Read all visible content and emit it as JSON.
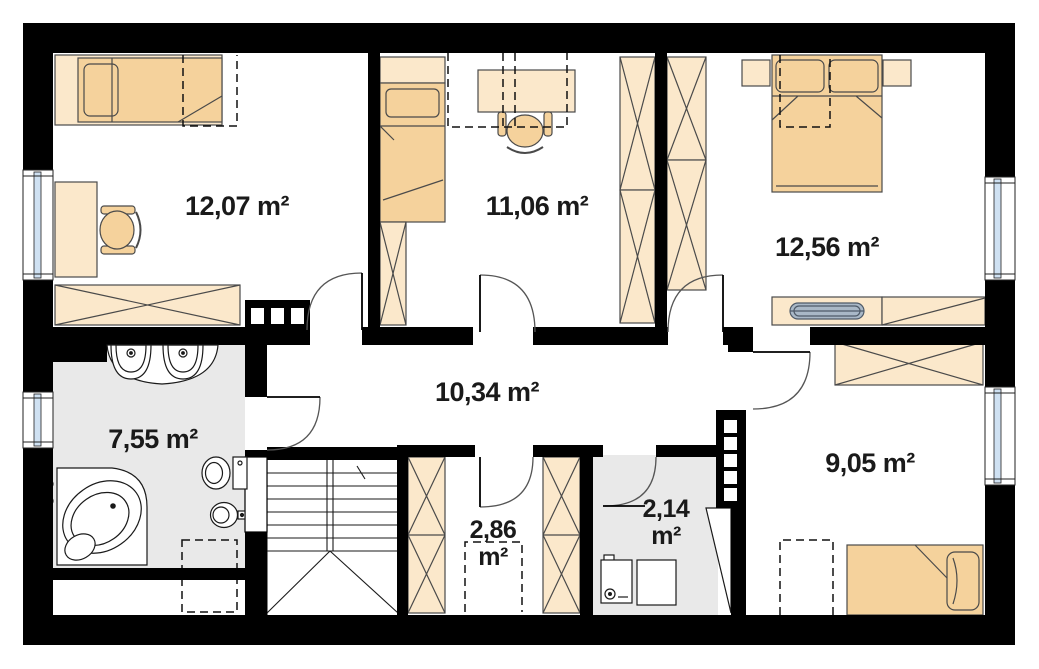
{
  "plan": {
    "type": "architectural-floor-plan",
    "rooms": {
      "bedroom_top_left": {
        "area_label": "12,07 m²"
      },
      "bedroom_top_middle": {
        "area_label": "11,06 m²"
      },
      "bedroom_top_right": {
        "area_label": "12,56 m²"
      },
      "hallway": {
        "area_label": "10,34 m²"
      },
      "bathroom": {
        "area_label": "7,55 m²"
      },
      "bedroom_bottom": {
        "area_label": "9,05 m²"
      },
      "wardrobe_room": {
        "area_value": "2,86",
        "area_unit": "m²"
      },
      "utility_room": {
        "area_value": "2,14",
        "area_unit": "m²"
      }
    },
    "colors": {
      "wall": "#000000",
      "furniture_fill": "#fbe8cb",
      "bed_fill": "#f5d29c",
      "floor_tile": "#e9e9e9",
      "window_glass": "#cfe1f2",
      "radiator": "#a9b8c7",
      "outline": "#4a4a4a"
    }
  }
}
